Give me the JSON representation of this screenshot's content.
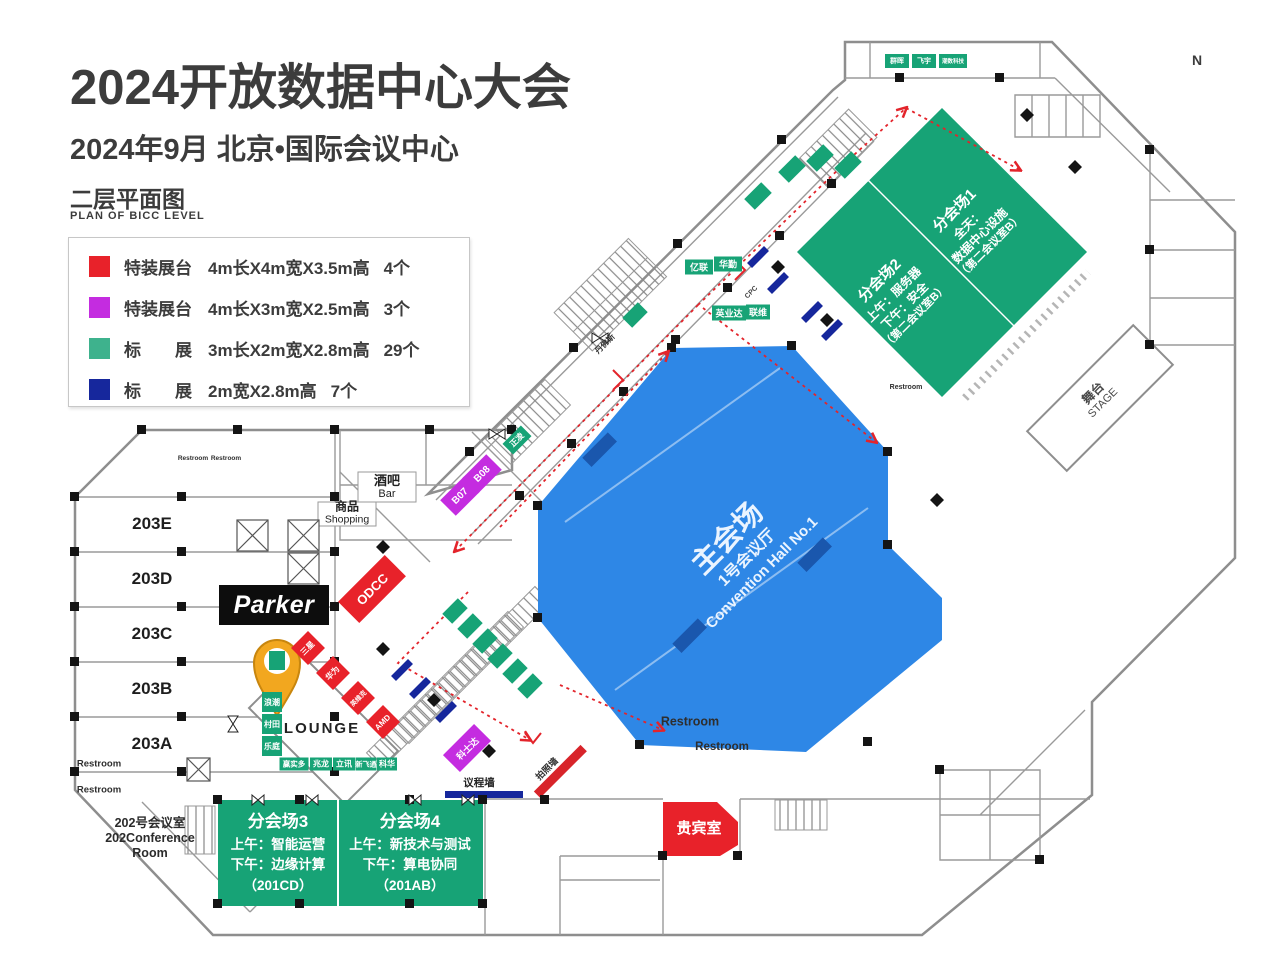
{
  "header": {
    "title": "2024开放数据中心大会",
    "subtitle": "2024年9月  北京•国际会议中心",
    "plan_title": "二层平面图",
    "plan_subtitle": "PLAN OF BICC LEVEL",
    "north": "N"
  },
  "legend": {
    "items": [
      {
        "color": "#e8222a",
        "label": "特装展台",
        "spec": "4m长X4m宽X3.5m高",
        "count": "4个"
      },
      {
        "color": "#c42ce0",
        "label": "特装展台",
        "spec": "4m长X3m宽X2.5m高",
        "count": "3个"
      },
      {
        "color": "#3eb28d",
        "label": "标　　展",
        "spec": "3m长X2m宽X2.8m高",
        "count": "29个"
      },
      {
        "color": "#16279c",
        "label": "标　　展",
        "spec": "2m宽X2.8m高",
        "count": "7个"
      }
    ]
  },
  "halls": {
    "main": {
      "name": "主会场",
      "cn": "1号会议厅",
      "en": "Convention Hall No.1"
    },
    "b1": {
      "title": "分会场1",
      "l1": "全天：",
      "l2": "数据中心设施",
      "l3": "（第二会议室B）"
    },
    "b2": {
      "title": "分会场2",
      "l1": "上午：服务器",
      "l2": "下午：安全",
      "l3": "（第二会议室B）"
    },
    "b3": {
      "title": "分会场3",
      "l1": "上午：智能运营",
      "l2": "下午：边缘计算",
      "l3": "（201CD）"
    },
    "b4": {
      "title": "分会场4",
      "l1": "上午：新技术与测试",
      "l2": "下午：算电协同",
      "l3": "（201AB）"
    },
    "conf202": {
      "l1": "202号会议室",
      "l2": "202Conference",
      "l3": "Room"
    },
    "vip": "贵宾室",
    "stage": {
      "cn": "舞台",
      "en": "STAGE"
    },
    "lounge": "LOUNGE",
    "bar": {
      "cn": "酒吧",
      "en": "Bar"
    },
    "shopping": {
      "cn": "商品",
      "en": "Shopping"
    },
    "rooms203": [
      "203E",
      "203D",
      "203C",
      "203B",
      "203A"
    ],
    "restroom": "Restroom"
  },
  "booths": {
    "parker": "Parker",
    "odcc": "ODCC",
    "red": [
      "三星",
      "华为",
      "英维克",
      "AMD"
    ],
    "b07": "B07",
    "b08": "B08",
    "kstar": "科士达",
    "row_bottom": [
      "赢实多",
      "兆龙",
      "立讯",
      "新飞通",
      "科华"
    ],
    "col_left": [
      "浪潮",
      "村田",
      "乐庭"
    ],
    "top_row": [
      "群晖",
      "飞宇",
      "潮数科技"
    ],
    "pair_a": [
      "亿联",
      "华勤"
    ],
    "pair_b": [
      "英业达",
      "联维"
    ],
    "danfoss": "丹佛斯",
    "zhengling": "正凌",
    "cpc": "CPC"
  },
  "walls": {
    "agenda": "议程墙",
    "photo": "拍照墙"
  }
}
